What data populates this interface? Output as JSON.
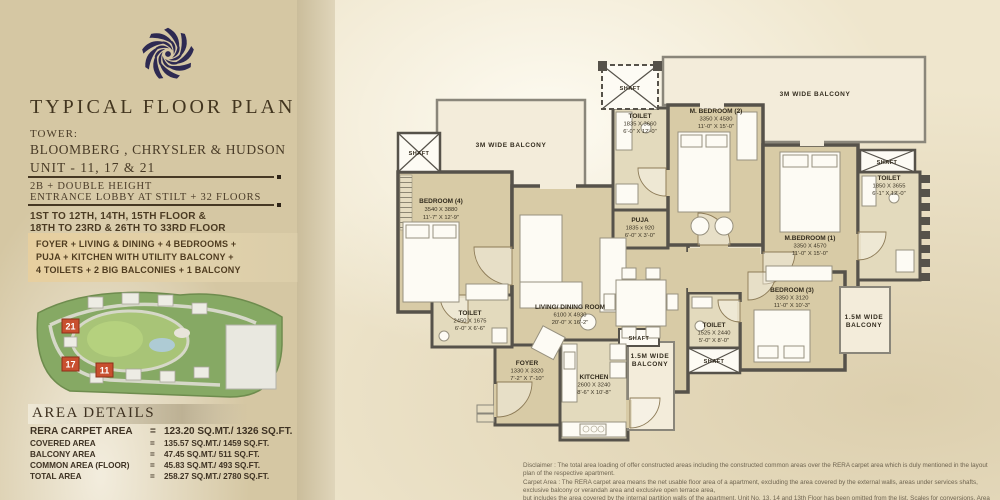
{
  "sidebar": {
    "title": "TYPICAL FLOOR PLAN",
    "tower_label": "TOWER:",
    "tower_names": "BLOOMBERG , CHRYSLER & HUDSON",
    "unit_line": "UNIT - 11, 17 & 21",
    "config_line1": "2B + DOUBLE HEIGHT",
    "config_line2": "ENTRANCE LOBBY AT STILT + 32 FLOORS",
    "floors_line1": "1ST TO 12TH, 14TH, 15TH FLOOR &",
    "floors_line2": "18TH TO 23RD & 26TH TO 33RD FLOOR",
    "features_line1": "FOYER +  LIVING & DINING + 4 BEDROOMS +",
    "features_line2": "PUJA + KITCHEN WITH UTILITY BALCONY +",
    "features_line3": "4 TOILETS + 2 BIG BALCONIES + 1 BALCONY",
    "site_map_units": {
      "u21": "21",
      "u17": "17",
      "u11": "11"
    },
    "area": {
      "title": "AREA DETAILS",
      "eq": "=",
      "rows": [
        {
          "label": "RERA CARPET AREA",
          "value": "123.20 SQ.MT./ 1326 SQ.FT."
        },
        {
          "label": "COVERED AREA",
          "value": "135.57 SQ.MT./ 1459 SQ.FT."
        },
        {
          "label": "BALCONY AREA",
          "value": "47.45 SQ.MT./ 511 SQ.FT."
        },
        {
          "label": "COMMON AREA (FLOOR)",
          "value": "45.83 SQ.MT./ 493 SQ.FT."
        },
        {
          "label": "TOTAL AREA",
          "value": "258.27 SQ.MT./ 2780 SQ.FT."
        }
      ]
    }
  },
  "plan": {
    "balcony_3m": "3M WIDE BALCONY",
    "balcony_15_l1": "1.5M WIDE",
    "balcony_15_l2": "BALCONY",
    "shaft": "SHAFT",
    "rooms": {
      "bedroom4": {
        "name": "BEDROOM (4)",
        "mm": "3540 X 3880",
        "ft": "11'-7\" X 12'-9\""
      },
      "toilet_top": {
        "name": "TOILET",
        "mm": "1835 X 3660",
        "ft": "6'-0\" X 12'-0\""
      },
      "mbedroom2": {
        "name": "M. BEDROOM (2)",
        "mm": "3350 X 4580",
        "ft": "11'-0\" X 15'-0\""
      },
      "toilet_right": {
        "name": "TOILET",
        "mm": "1850 X 3655",
        "ft": "6'-1\" X 12'-0\""
      },
      "mbedroom1": {
        "name": "M.BEDROOM (1)",
        "mm": "3350 X 4570",
        "ft": "11'-0\" X 15'-0\""
      },
      "puja": {
        "name": "PUJA",
        "mm": "1835 x 920",
        "ft": "6'-0\" X 3'-0\""
      },
      "living": {
        "name": "LIVING/ DINING ROOM",
        "mm": "6100 X 4930",
        "ft": "20'-0\" X 16'-2\""
      },
      "toilet_left": {
        "name": "TOILET",
        "mm": "2450 X 1675",
        "ft": "6'-0\" X 6'-6\""
      },
      "foyer": {
        "name": "FOYER",
        "mm": "1330 X 3320",
        "ft": "7'-2\" X 7'-10\""
      },
      "kitchen": {
        "name": "KITCHEN",
        "mm": "2600 X 3240",
        "ft": "8'-6\" X 10'-8\""
      },
      "bedroom3": {
        "name": "BEDROOM (3)",
        "mm": "3350 X 3120",
        "ft": "11'-0\" X 10'-3\""
      },
      "toilet_b3": {
        "name": "TOILET",
        "mm": "1525 X 2440",
        "ft": "5'-0\" X 8'-0\""
      }
    },
    "disclaimer_line1": "Disclaimer : The total area loading of offer constructed areas including the constructed common areas over the RERA carpet area which is duly mentioned in the layout plan of the respective apartment.",
    "disclaimer_line2": "Carpet Area : The RERA carpet area means the net usable floor area of a apartment, excluding the area covered by the external walls, areas under services shafts, exclusive balcony or verandah area and exclusive open terrace area,",
    "disclaimer_line3": "but includes the area covered by the internal partition walls of the apartment. Unit No. 13, 14 and 13th Floor has been omitted from the list. Scales for conversions, Area 1.000 Sq.mt. = 10.764 Sq.ft., Dimension 304.8 mm=1.0 Foot."
  },
  "colors": {
    "sidebar_bg": "#d5c7a3",
    "plan_bg": "#efe6cd",
    "room_fill": "#d8cba6",
    "balcony_fill": "#f3ecda",
    "wall": "#56524a",
    "logo_navy": "#2e2a52",
    "marker_red": "#c8502f",
    "text_brown": "#42351f"
  }
}
